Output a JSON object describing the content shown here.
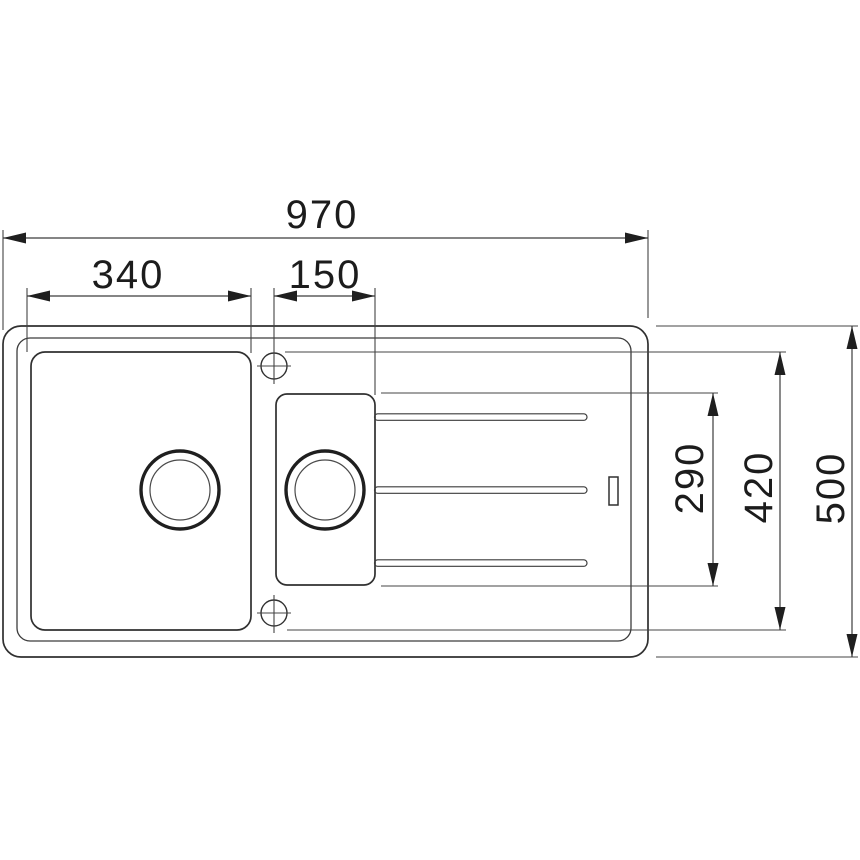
{
  "drawing": {
    "kind": "sink-top-view-dimension-drawing",
    "dimensions": {
      "overall_width": "970",
      "main_bowl_width": "340",
      "half_bowl_width": "150",
      "half_bowl_depth": "290",
      "bowl_depth": "420",
      "overall_depth": "500"
    },
    "colors": {
      "line": "#3c3c3c",
      "outline": "#303030",
      "text": "#1c1c1c",
      "background": "#ffffff"
    }
  }
}
